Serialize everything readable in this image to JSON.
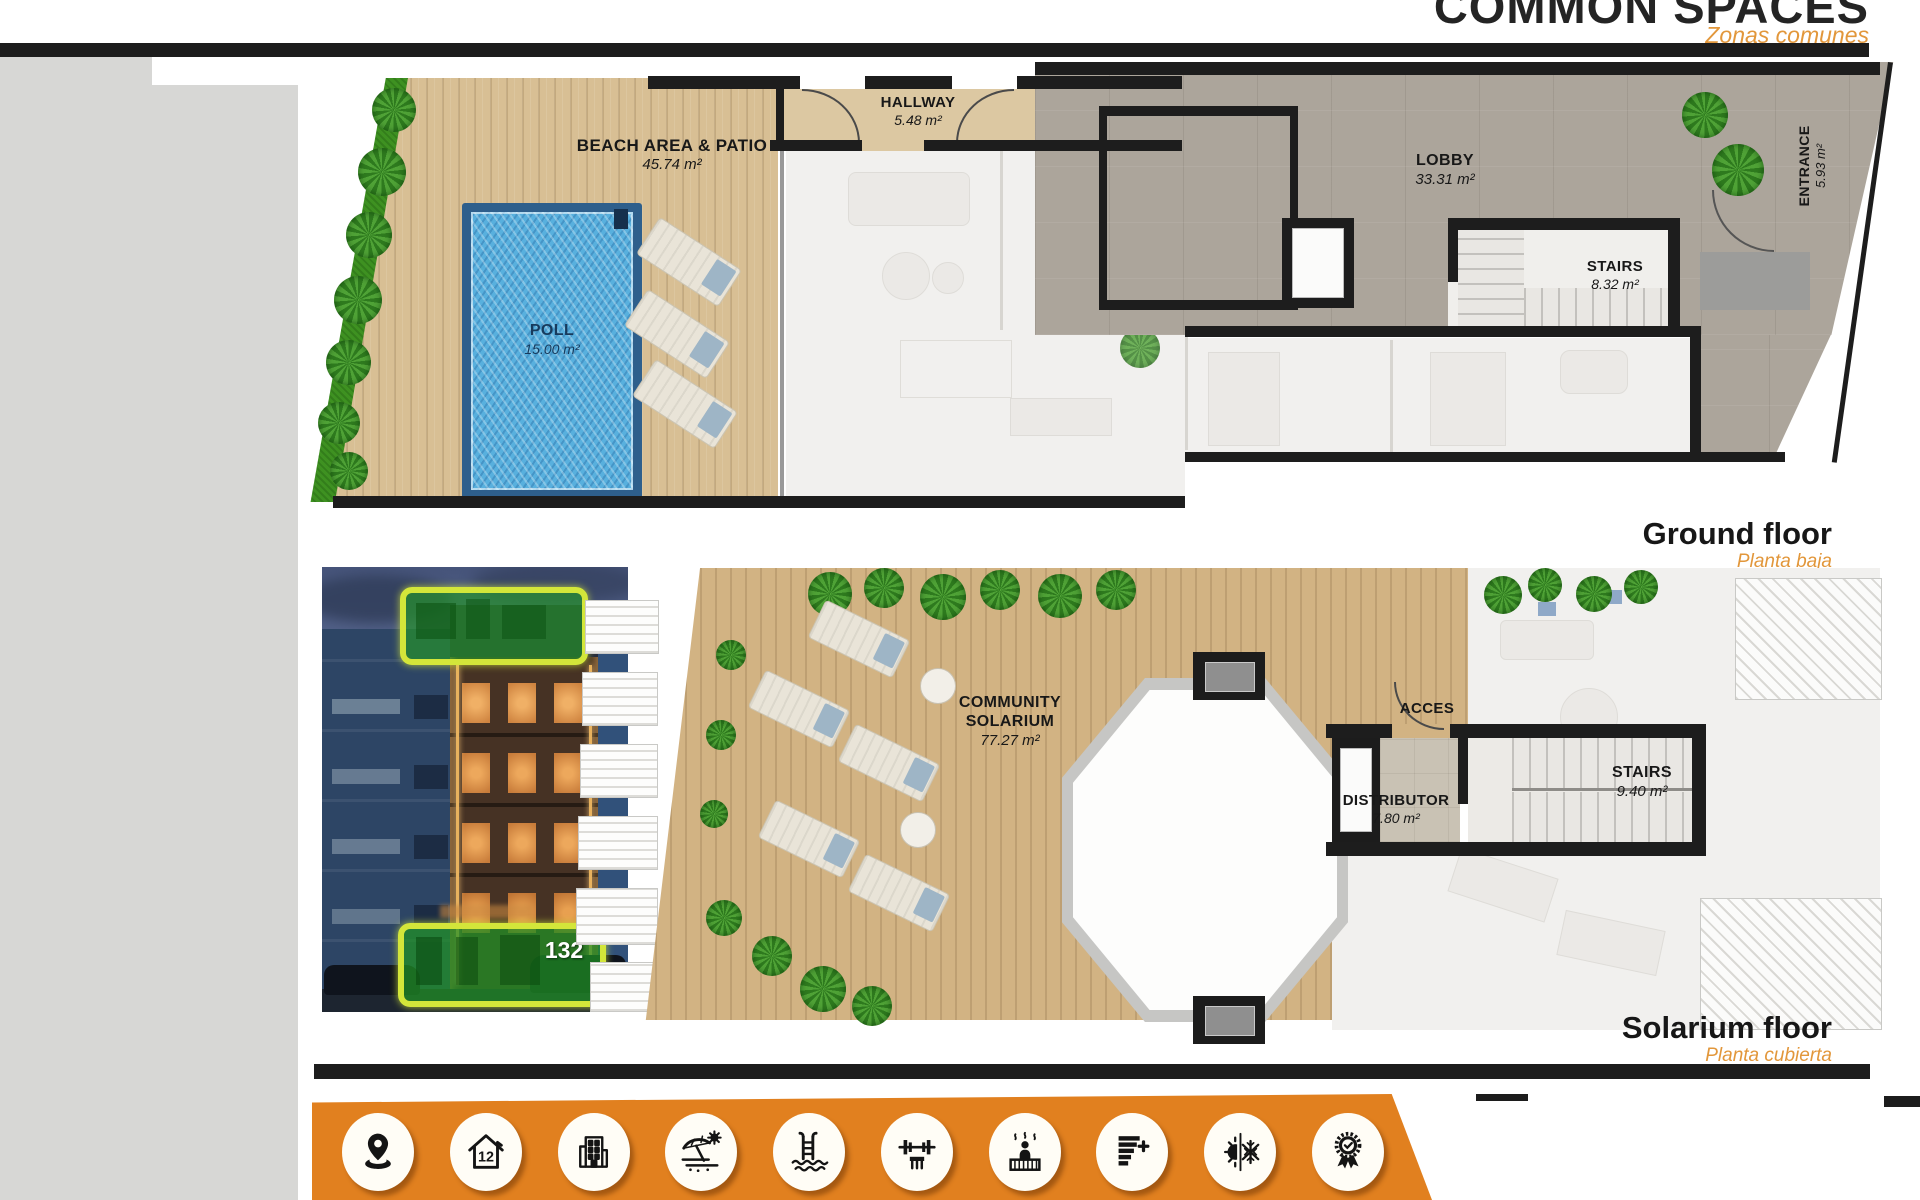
{
  "header": {
    "title": "COMMON SPACES",
    "subtitle": "Zonas comunes"
  },
  "ground_floor": {
    "caption": "Ground floor",
    "caption_es": "Planta baja",
    "beach": {
      "name": "BEACH AREA & PATIO",
      "area": "45.74 m²"
    },
    "pool": {
      "name": "POLL",
      "area": "15.00 m²"
    },
    "hallway": {
      "name": "HALLWAY",
      "area": "5.48 m²"
    },
    "gym": {
      "name": "GYM & SAUNA",
      "area": "11.00 m²"
    },
    "lobby": {
      "name": "LOBBY",
      "area": "33.31 m²"
    },
    "stairs": {
      "name": "STAIRS",
      "area": "8.32 m²"
    },
    "entrance": {
      "name": "ENTRANCE",
      "area": "5.93 m²"
    }
  },
  "solarium_floor": {
    "caption": "Solarium floor",
    "caption_es": "Planta cubierta",
    "community_solarium": {
      "line1": "COMMUNITY",
      "line2": "SOLARIUM",
      "area": "77.27 m²"
    },
    "acces": {
      "name": "ACCES"
    },
    "distributor": {
      "name": "DISTRIBUTOR",
      "area": "7.80 m²"
    },
    "stairs": {
      "name": "STAIRS",
      "area": "9.40 m²"
    }
  },
  "photo": {
    "unit_badge": "132"
  },
  "amenity_bar": {
    "house_years": "12",
    "icons": [
      "location-pin",
      "house-12-years",
      "apartment-building",
      "beach-umbrella",
      "pool-ladder",
      "gym-fitness",
      "sauna",
      "energy-rating-plus",
      "climate-sun-snowflake",
      "quality-medal"
    ]
  },
  "colors": {
    "accent_orange": "#E1801F",
    "label_orange": "#E2973B",
    "highlight_green": "#2FAE2F",
    "highlight_border": "#D3E63A",
    "pool_blue": "#55AEDC",
    "wall_black": "#1C1C1C"
  }
}
